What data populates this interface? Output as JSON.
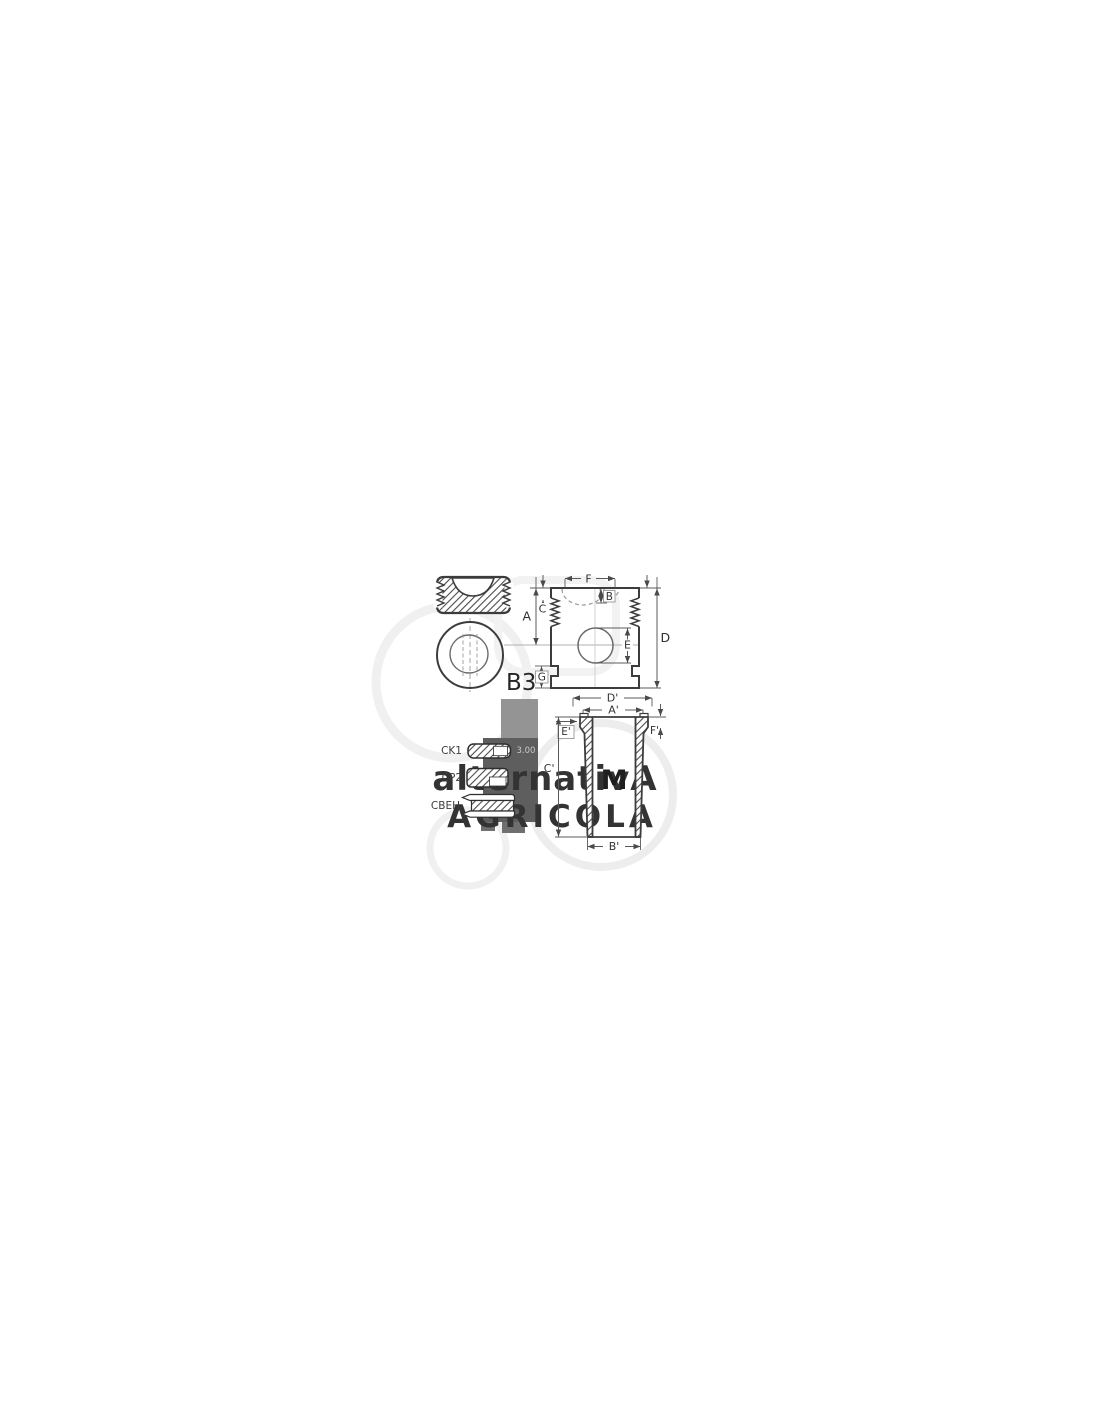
{
  "watermark": {
    "line1": "alternativA",
    "line2": "AGRICOLA"
  },
  "views": {
    "piston_top": {
      "label": "B3"
    },
    "piston_side": {
      "dims": {
        "f": "F",
        "b": "B",
        "c": "C",
        "a": "A",
        "e": "E",
        "d": "D",
        "g": "G"
      }
    },
    "liner": {
      "label": "M",
      "dims": {
        "d2": "D'",
        "a2": "A'",
        "e2": "E'",
        "f2": "F'",
        "c2": "C'",
        "b2": "B'"
      }
    },
    "rings": {
      "items": [
        {
          "label": "CK1",
          "value": "3.00"
        },
        {
          "label": "CP2"
        },
        {
          "label": "CBEH"
        }
      ]
    }
  }
}
